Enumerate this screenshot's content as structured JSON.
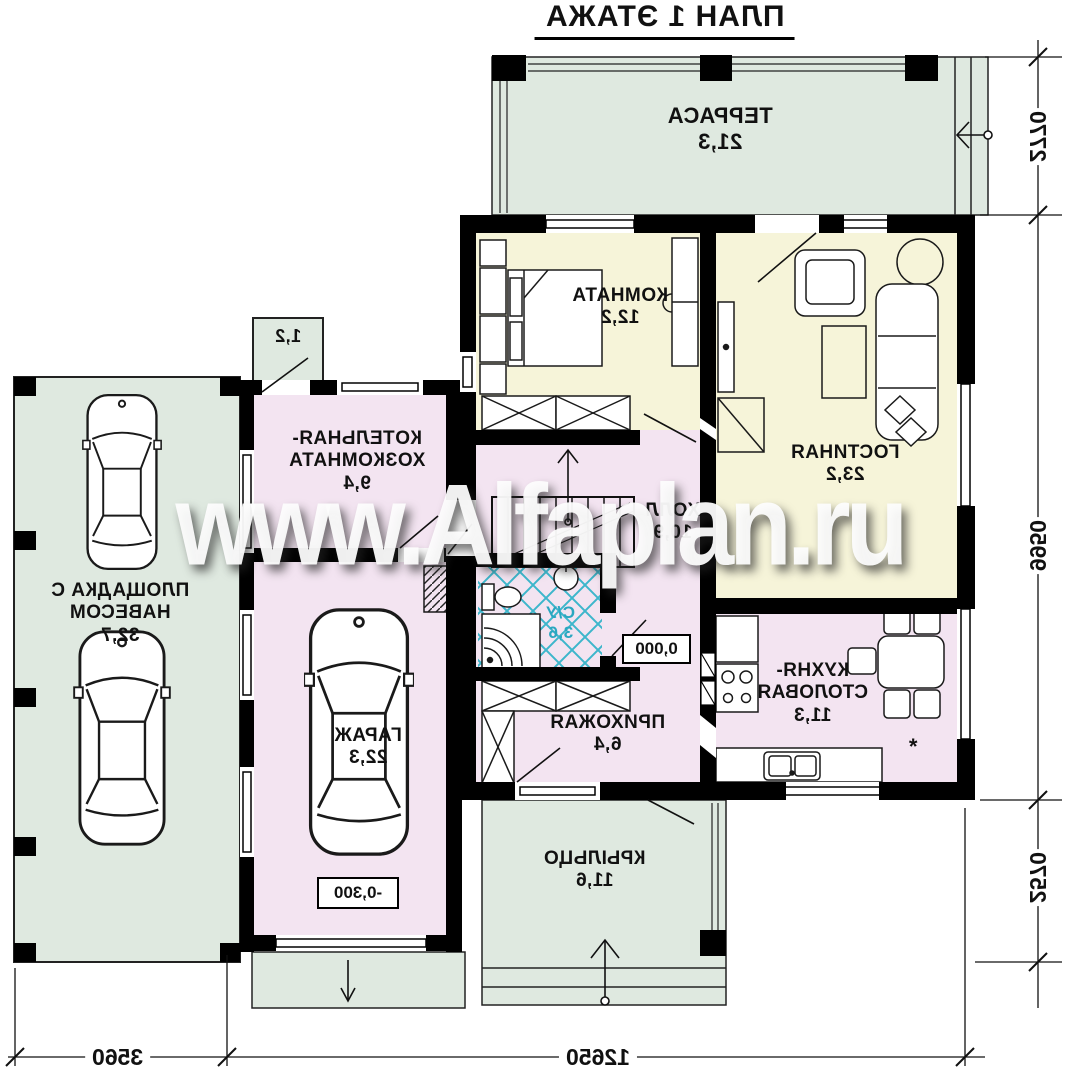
{
  "title": "ПЛАН 1 ЭТАЖА",
  "watermark": "www.Alfaplan.ru",
  "palette": {
    "wall": "#000000",
    "room_green": "#dfe9e0",
    "room_yellow": "#f6f4d9",
    "room_pink": "#f3e4f1",
    "tile_teal": "#3db6cb",
    "wc_text": "#2aa7c0",
    "background": "#ffffff"
  },
  "rooms": {
    "terrace": {
      "name": "ТЕРРАСА",
      "area": "21,3"
    },
    "bedroom": {
      "name": "КОМНАТА",
      "area": "12,2"
    },
    "living": {
      "name": "ГОСТИНАЯ",
      "area": "23,2"
    },
    "boiler": {
      "line1": "КОТЕЛЬНАЯ-",
      "line2": "ХОЗКОМНАТА",
      "area": "9,4"
    },
    "hall": {
      "name": "ХОЛЛ",
      "area": "10,9"
    },
    "wc": {
      "name": "С/У",
      "area": "3,6"
    },
    "kitchen": {
      "line1": "КУХНЯ-",
      "line2": "СТОЛОВАЯ",
      "area": "11,3"
    },
    "entry": {
      "name": "ПРИХОЖАЯ",
      "area": "6,4"
    },
    "garage": {
      "name": "ГАРАЖ",
      "area": "22,3"
    },
    "porch": {
      "name": "КРЫЛЬЦО",
      "area": "11,6"
    },
    "carport": {
      "name": "ПЛОЩАДКА С НАВЕСОМ",
      "area": "32,7"
    },
    "stoop": {
      "area": "1,2"
    }
  },
  "elevations": {
    "ground": "0,000",
    "garage": "-0,300"
  },
  "dimensions": {
    "right": [
      "2770",
      "9950",
      "2570"
    ],
    "bottom": [
      "3560",
      "12650"
    ]
  },
  "symbols": {
    "kitchen_mark": "*"
  }
}
